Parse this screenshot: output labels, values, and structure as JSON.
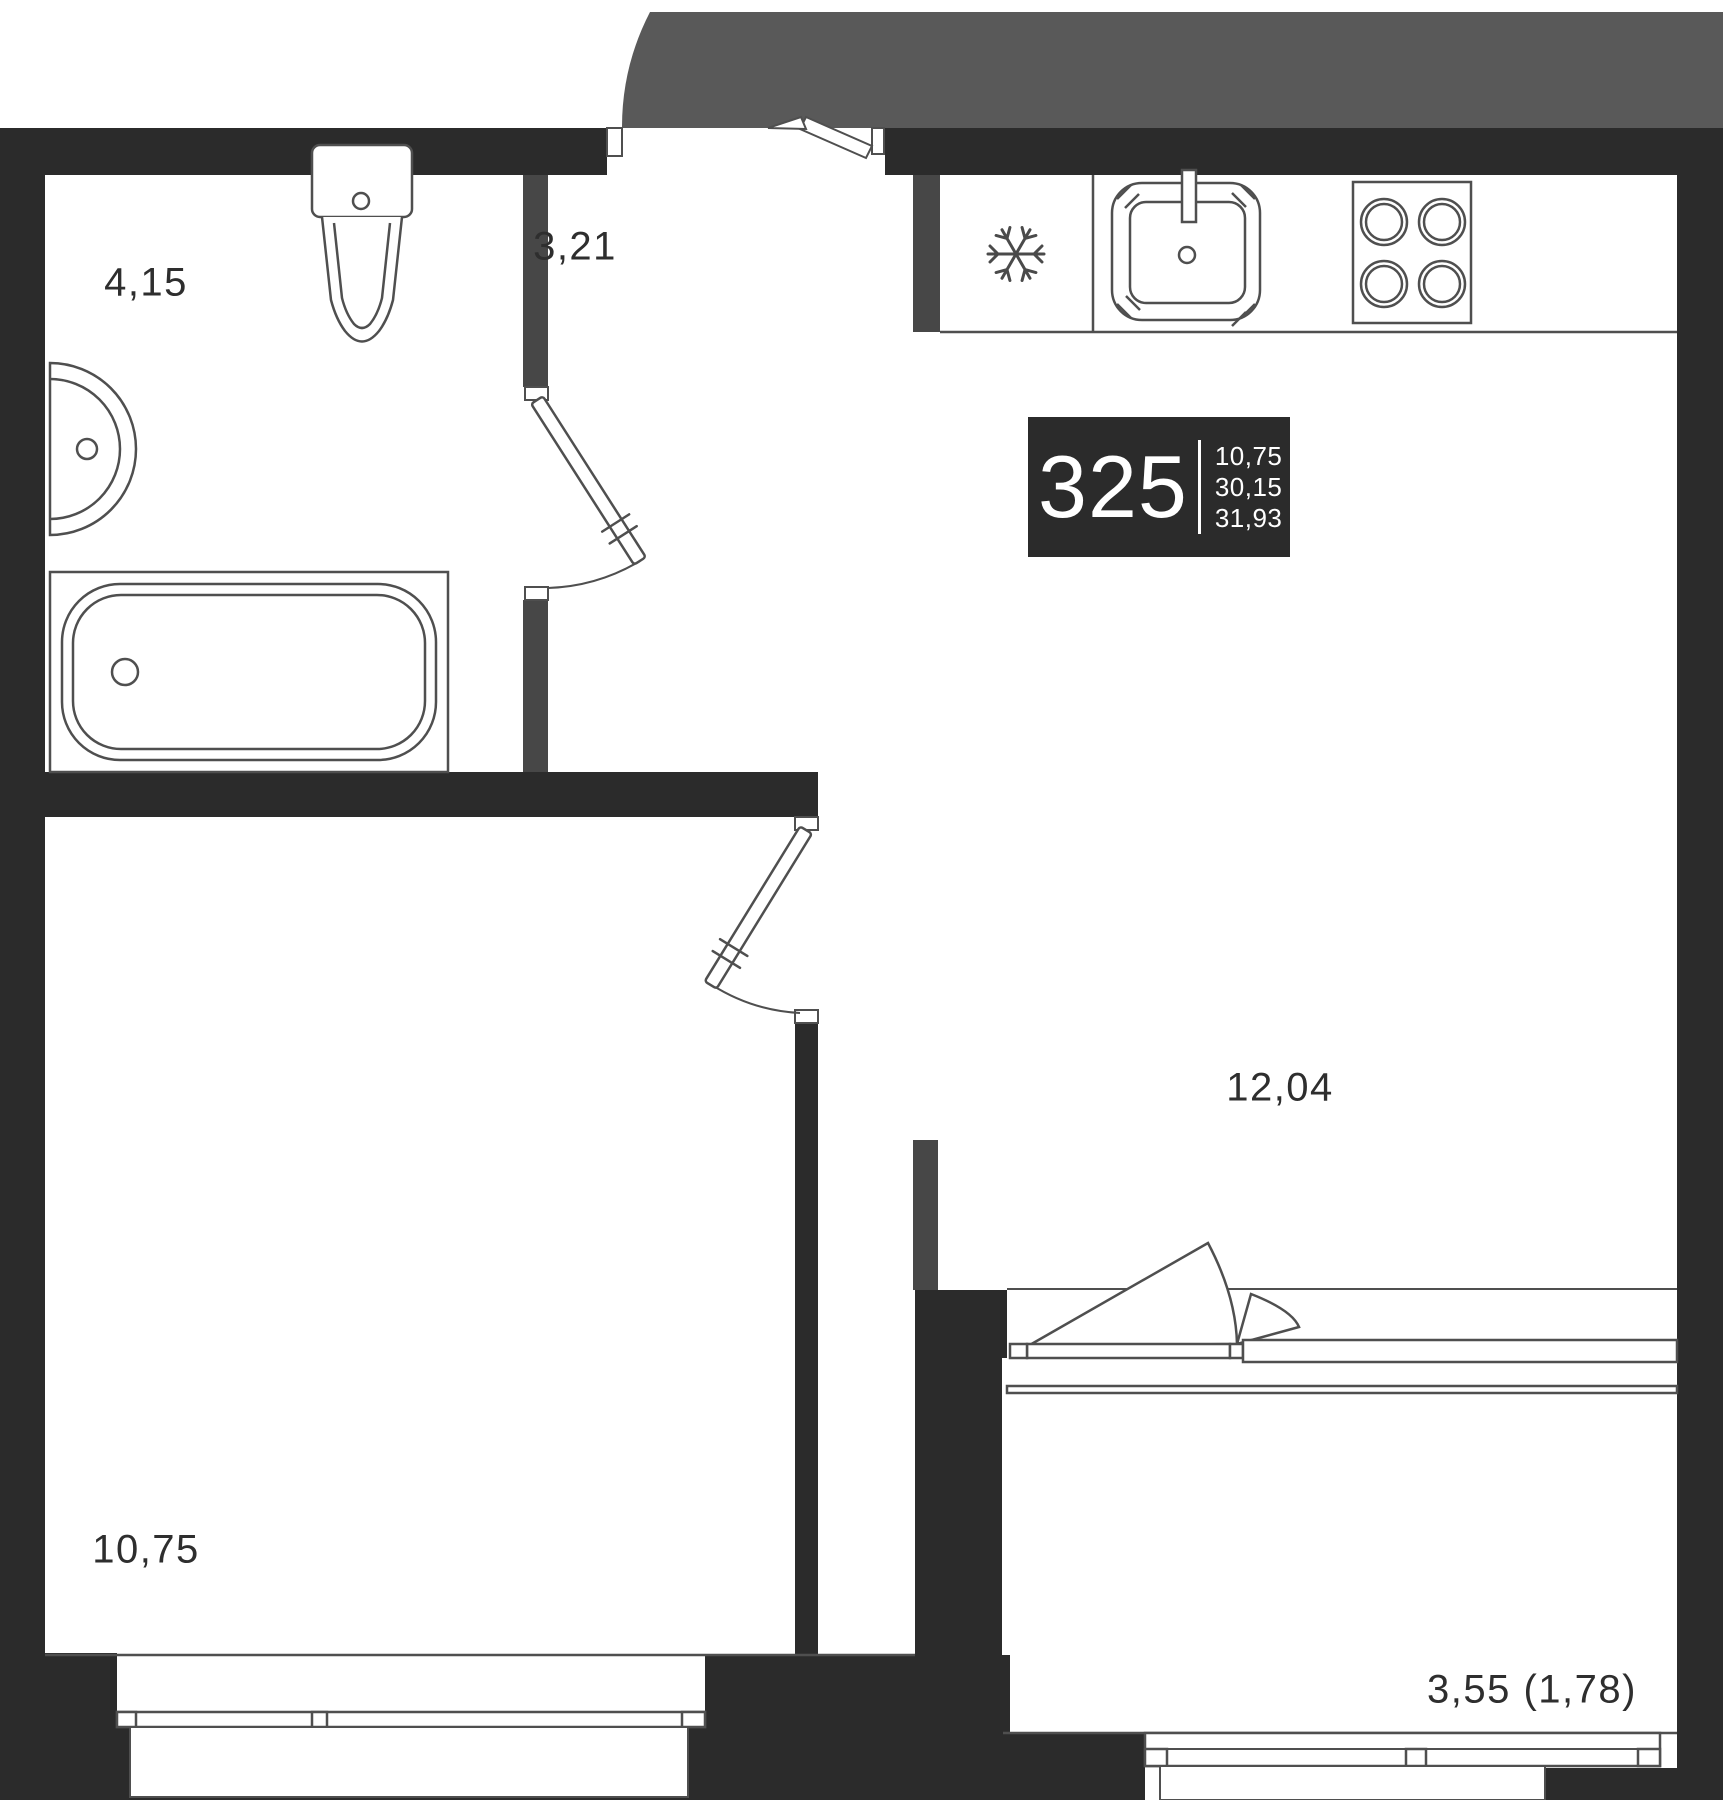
{
  "plan": {
    "unit_box": {
      "number": "325",
      "area_living": "10,75",
      "area_without_balcony": "30,15",
      "area_total": "31,93"
    },
    "rooms": {
      "bathroom": {
        "label": "4,15"
      },
      "hallway": {
        "label": "3,21"
      },
      "kitchen_living": {
        "label": "12,04"
      },
      "bedroom": {
        "label": "10,75"
      },
      "balcony": {
        "label": "3,55 (1,78)"
      }
    },
    "icons": {
      "fridge": "snowflake-icon",
      "stove": "four-burner-stove-icon",
      "sink_kitchen": "kitchen-sink-icon",
      "sink_bath": "washbasin-icon",
      "toilet": "toilet-icon",
      "bathtub": "bathtub-icon"
    },
    "colors": {
      "wall": "#2b2b2b",
      "partition": "#474747",
      "entry_zone": "#595959",
      "fixture_line": "#4f4f4f",
      "label_text": "#2e2e2e",
      "box_bg": "#2b2b2b",
      "box_text": "#ffffff"
    }
  }
}
